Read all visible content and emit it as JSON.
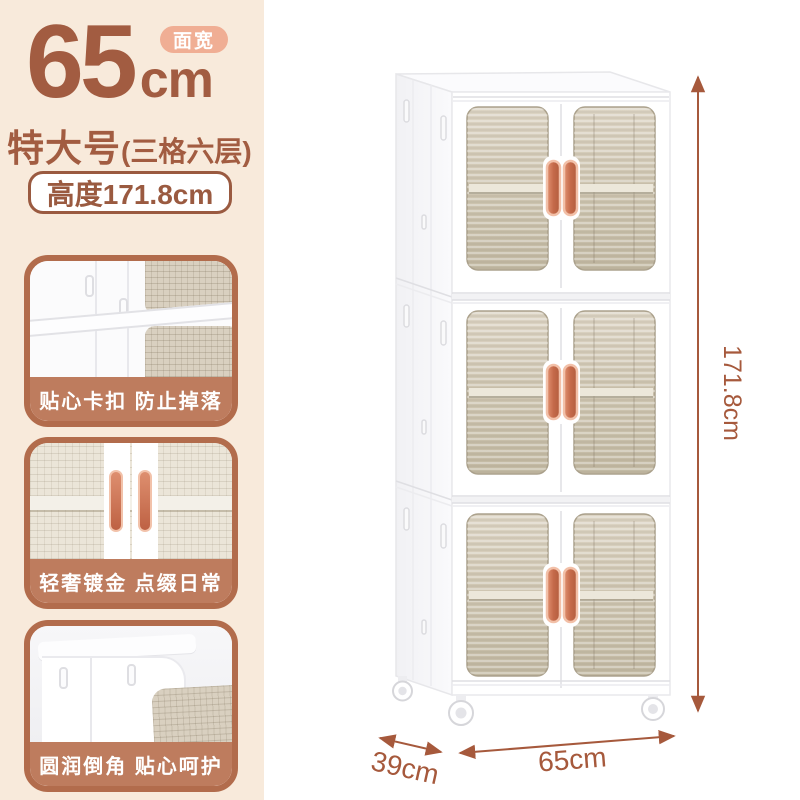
{
  "header": {
    "width_value": "65",
    "width_unit": "cm",
    "badge": "面宽",
    "size_name": "特大号",
    "size_detail": "(三格六层)",
    "height_label": "高度171.8cm"
  },
  "features": [
    {
      "caption": "贴心卡扣 防止掉落"
    },
    {
      "caption": "轻奢镀金 点缀日常"
    },
    {
      "caption": "圆润倒角 贴心呵护"
    }
  ],
  "dimensions": {
    "height": "171.8cm",
    "depth": "39cm",
    "width": "65cm"
  },
  "colors": {
    "panel_bg": "#F8EADB",
    "accent_text": "#A25C41",
    "badge_bg": "#F0AE94",
    "card_border": "#B26C4C",
    "caption_band": "#BE7C5E",
    "dimension_line": "#A6593C",
    "handle_copper": "#C96F50",
    "window_tint": "#CFC6B2"
  }
}
